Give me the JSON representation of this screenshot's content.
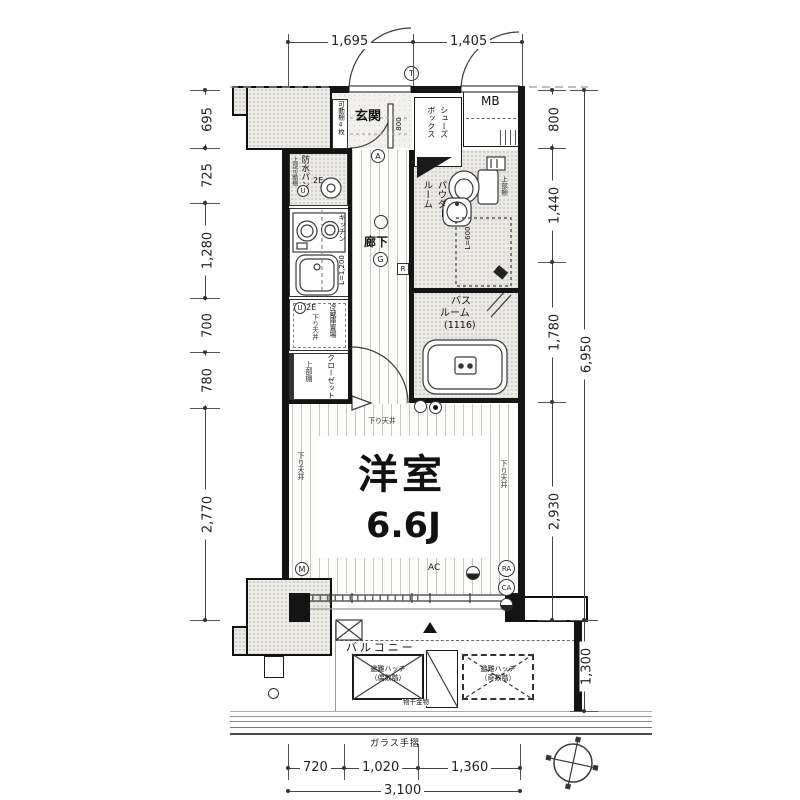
{
  "dims": {
    "top": [
      "1,695",
      "1,405"
    ],
    "left": [
      "695",
      "725",
      "1,280",
      "700",
      "780",
      "2,770"
    ],
    "right": [
      "800",
      "1,440",
      "1,780",
      "2,930"
    ],
    "right_total": "6,950",
    "balcony_depth": "1,300",
    "bottom": [
      "720",
      "1,020",
      "1,360"
    ],
    "bottom_total": "3,100"
  },
  "rooms": {
    "genkan": "玄関",
    "shoes_box_l1": "シューズ",
    "shoes_box_l2": "ボックス",
    "mb": "MB",
    "corridor": "廊下",
    "powder_l1": "パウダー",
    "powder_l2": "ルーム",
    "bath_l1": "バス",
    "bath_l2": "ルーム",
    "bath_size": "(1116)",
    "main_room": "洋室",
    "main_room_size": "6.6J",
    "balcony": "バルコニー",
    "kitchen": "キッチン",
    "kitchen_len": "L=1,200",
    "fridge": "冷蔵庫置場",
    "closet": "クローゼット",
    "pan": "防水パン"
  },
  "notes": {
    "shelf4": "可動棚4枚",
    "upper_mov_shelf": "上部可動棚",
    "upper_shelf_a": "上部棚",
    "upper_shelf_b": "上部棚",
    "down_ceil_a": "下り天井",
    "down_ceil_b": "下り天井",
    "down_ceil_c": "下り天井",
    "down_ceil_d": "下り天井",
    "basin_len": "L=600",
    "door_w": "800",
    "e2_a": "2E",
    "e2_b": "2E",
    "ac": "AC",
    "hatch_even_l1": "避難ハッチ",
    "hatch_even_l2": "（偶数階）",
    "hatch_odd_l1": "避難ハッチ",
    "hatch_odd_l2": "（奇数階）",
    "monohoshi": "物干金物",
    "glass_rail": "ガラス手摺"
  },
  "markers": {
    "t": "T",
    "a": "A",
    "g": "G",
    "r": "R",
    "u_a": "U",
    "u_b": "U",
    "m": "M",
    "ra": "RA",
    "ca": "CA"
  }
}
